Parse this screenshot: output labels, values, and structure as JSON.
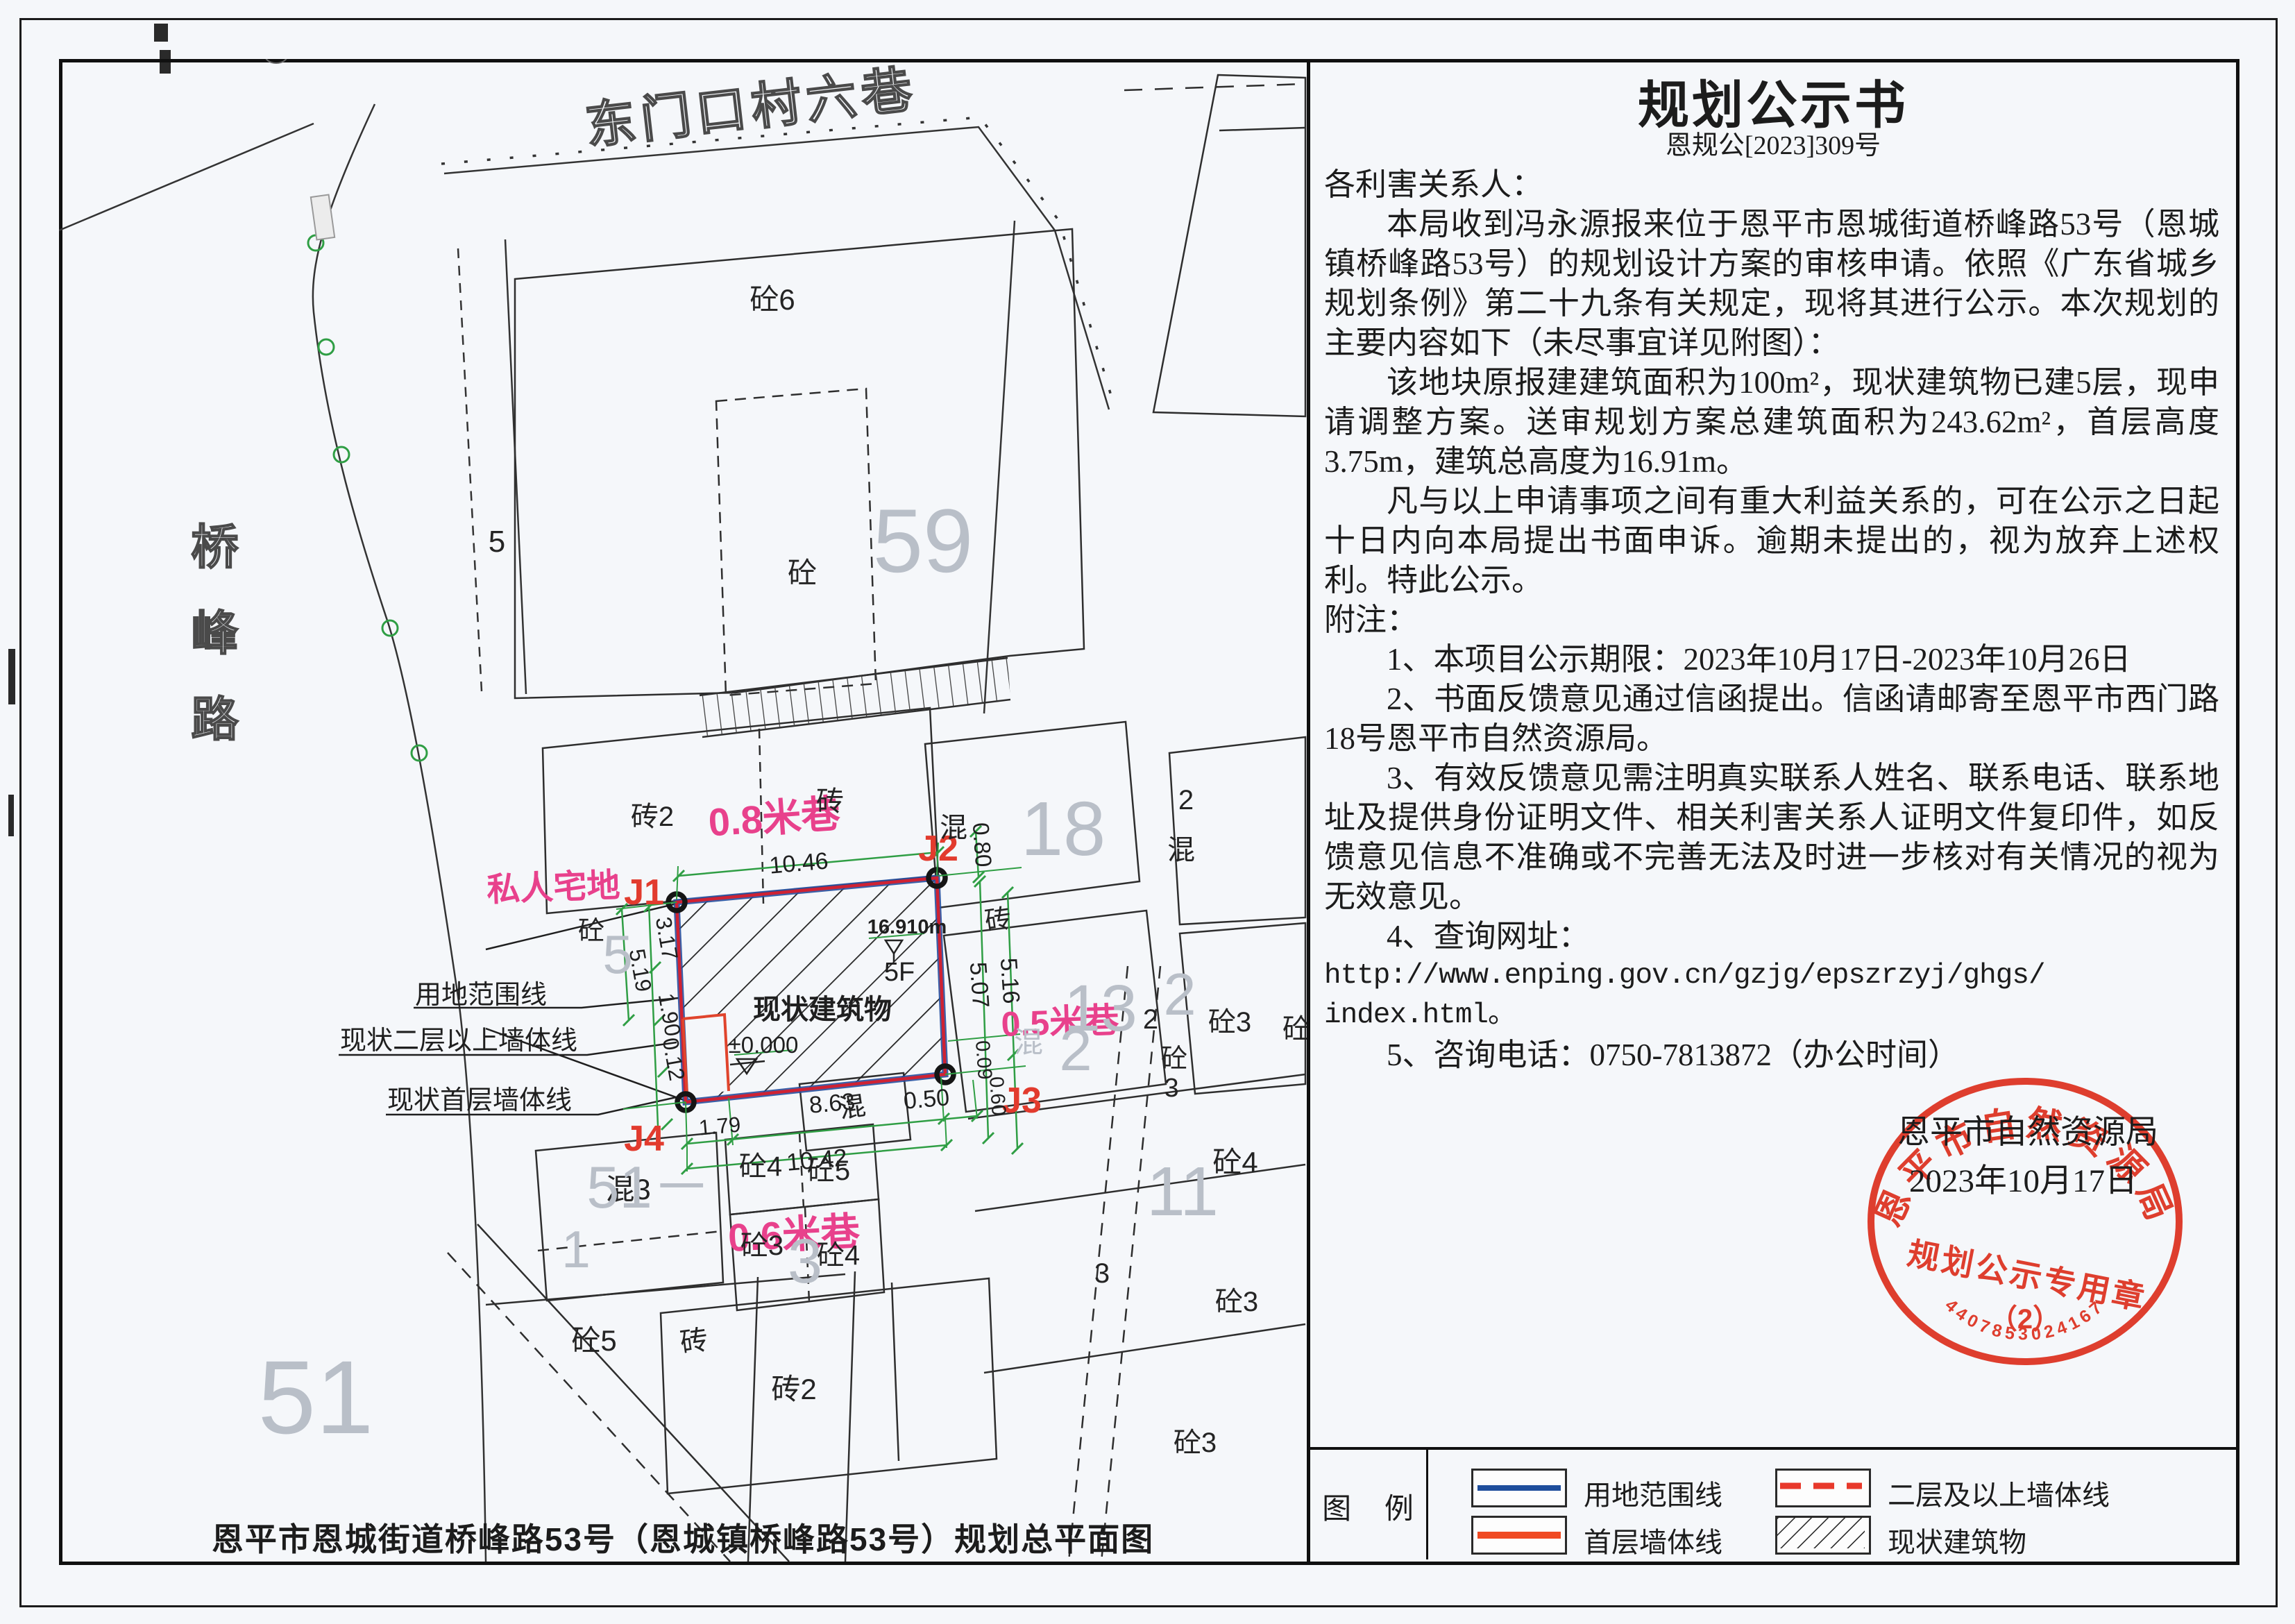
{
  "notice": {
    "title": "规划公示书",
    "doc_no": "恩规公[2023]309号",
    "salutation": "各利害关系人：",
    "p1": "本局收到冯永源报来位于恩平市恩城街道桥峰路53号（恩城镇桥峰路53号）的规划设计方案的审核申请。依照《广东省城乡规划条例》第二十九条有关规定，现将其进行公示。本次规划的主要内容如下（未尽事宜详见附图）：",
    "p2": "该地块原报建建筑面积为100m²，现状建筑物已建5层，现申请调整方案。送审规划方案总建筑面积为243.62m²，首层高度3.75m，建筑总高度为16.91m。",
    "p3": "凡与以上申请事项之间有重大利益关系的，可在公示之日起十日内向本局提出书面申诉。逾期未提出的，视为放弃上述权利。特此公示。",
    "notes_label": "附注：",
    "n1": "1、本项目公示期限：2023年10月17日-2023年10月26日",
    "n2": "2、书面反馈意见通过信函提出。信函请邮寄至恩平市西门路18号恩平市自然资源局。",
    "n3": "3、有效反馈意见需注明真实联系人姓名、联系电话、联系地址及提供身份证明文件、相关利害关系人证明文件复印件，如反馈意见信息不准确或不完善无法及时进一步核对有关情况的视为无效意见。",
    "n4": "4、查询网址：",
    "url1": "http://www.enping.gov.cn/gzjg/epszrzyj/ghgs/",
    "url2": "index.html。",
    "n5": "5、咨询电话：0750-7813872（办公时间）",
    "sign_org": "恩平市自然资源局",
    "sign_date": "2023年10月17日"
  },
  "stamp": {
    "arc_text": "恩平市自然资源局",
    "center_text": "规划公示专用章",
    "sub_label": "（2）",
    "serial": "4407853024167"
  },
  "legend": {
    "title": "图  例",
    "item_boundary": "用地范围线",
    "item_upper_wall": "二层及以上墙体线",
    "item_first_wall": "首层墙体线",
    "item_existing": "现状建筑物"
  },
  "caption": "恩平市恩城街道桥峰路53号（恩城镇桥峰路53号）规划总平面图",
  "map": {
    "labels": {
      "top_road": "东门口村六巷",
      "left_road": "桥峰路",
      "alley08": "0.8米巷",
      "alley06": "0.6米巷",
      "alley05": "0.5米巷",
      "private_plot": "私人宅地",
      "j1": "J1",
      "j2": "J2",
      "j3": "J3",
      "j4": "J4",
      "d1046": "10.46",
      "d080": "0.80",
      "d317": "3.17",
      "d519": "5.19",
      "d190": "1.90",
      "d012": "0.12",
      "d179": "1.79",
      "d863": "8.63",
      "d050": "0.50",
      "d1042": "10.42",
      "d507": "5.07",
      "d516": "5.16",
      "d009": "0.09",
      "d060": "0.60",
      "roof_level": "16.910m",
      "floors": "5F",
      "existing_building": "现状建筑物",
      "ground_level": "±0.000",
      "leader_boundary": "用地范围线",
      "leader_upper_wall": "现状二层以上墙体线",
      "leader_first_wall": "现状首层墙体线",
      "b_tong6": "砼6",
      "b_tong_nw": "砼",
      "road_lot5": "5",
      "b_zhuan2_n": "砖2",
      "b_zhuan_n": "砖",
      "b_hun_18": "混",
      "b_zhuan_e": "砖",
      "b_2_ne": "2",
      "b_hun_ne": "混",
      "b_hun3": "混3",
      "b_tong4_a": "砼4",
      "b_tong5_a": "砼5",
      "b_tong3_a": "砼3",
      "b_tong4_b": "砼4",
      "b_tong5_sw": "砼5",
      "b_zhuan_sw": "砖",
      "b_zhuan2_sw": "砖2",
      "b_hun_mid": "混",
      "b_2_se": "2",
      "b_tong3_se": "砼3",
      "b_tong_edge": "砼",
      "b_tong_stack": "砼",
      "b_3_stack": "3",
      "b_tong4_se": "砼4",
      "b_tong3_se2": "砼3",
      "b_3_mid": "3",
      "b_tong3_bot": "砼3",
      "b_tong_w": "砼",
      "f59": "59",
      "f18": "18",
      "f13": "13",
      "f11": "11",
      "f51a": "51",
      "f51b": "51－",
      "f2a": "2",
      "f2b": "2",
      "f1": "1",
      "f5": "5",
      "fhun": "混",
      "f3": "3"
    }
  }
}
